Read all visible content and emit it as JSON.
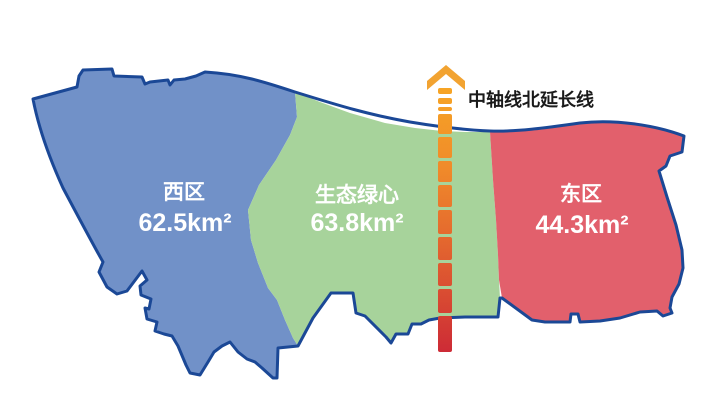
{
  "map": {
    "background": "#FFFFFF",
    "outline_color": "#1B4896",
    "label_text_color": "#FFFFFF",
    "regions": [
      {
        "name": "西区",
        "area": "62.5km²",
        "fill": "#7191C8"
      },
      {
        "name": "生态绿心",
        "area": "63.8km²",
        "fill": "#A7D39B"
      },
      {
        "name": "东区",
        "area": "44.3km²",
        "fill": "#E2606C"
      }
    ],
    "axis": {
      "label": "中轴线北延长线",
      "label_color": "#1A1A1A",
      "arrow_color": "#F2A331",
      "gradient": [
        "#F7A525",
        "#F08B2A",
        "#E56B2E",
        "#D84932",
        "#CD2B36"
      ]
    }
  }
}
